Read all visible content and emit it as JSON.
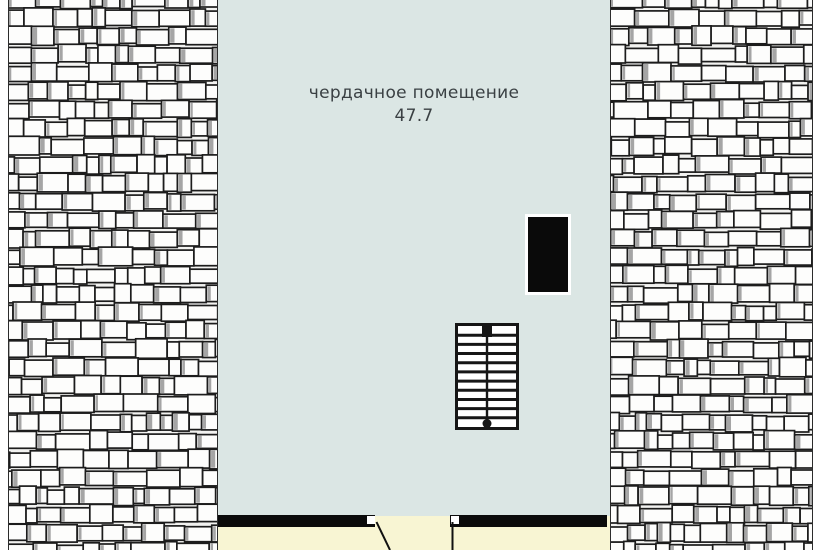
{
  "plan": {
    "room": {
      "label": "чердачное помещение",
      "area": "47.7"
    },
    "staircase": {
      "tread_lines": 10,
      "flights": 2
    },
    "colors": {
      "page_bg": "#ffffff",
      "room_fill": "#dbe6e4",
      "lower_floor_fill": "#f8f5d3",
      "wall": "#0b0b0b",
      "chimney": "#0a0a0a",
      "chimney_halo": "#ffffff",
      "stair_stroke": "#161616",
      "door_line": "#111111",
      "shingle_fill": "#fdfdfc",
      "shingle_stroke": "#1c1c1c",
      "shingle_shadow": "#8e8e8e",
      "roof_edge": "#2c2c2c",
      "label_text": "#3a4043"
    }
  }
}
